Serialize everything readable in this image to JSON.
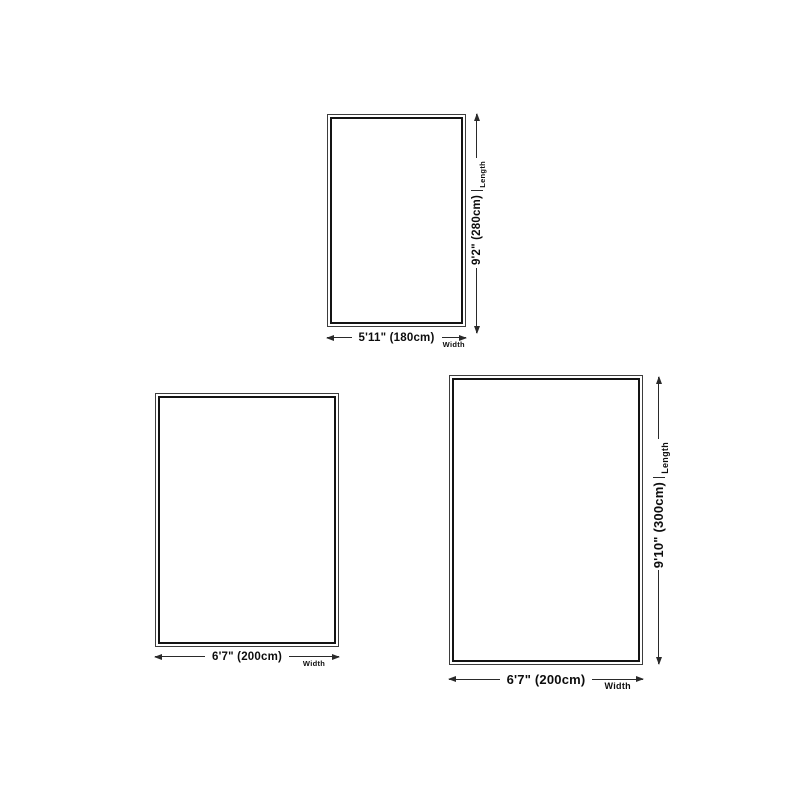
{
  "diagram": {
    "background": "#ffffff",
    "line_color": "#2a2a2a",
    "text_color": "#0d0d0d",
    "rug_outer_border": "#3d3d3d",
    "rug_inner_border": "#141414"
  },
  "rugs": [
    {
      "name": "rug-180x280",
      "width_value": "5'11\" (180cm)",
      "width_caption": "Width",
      "length_value": "9'2\" (280cm)",
      "length_caption": "Length"
    },
    {
      "name": "rug-200cm",
      "width_value": "6'7\" (200cm)",
      "width_caption": "Width"
    },
    {
      "name": "rug-200x300",
      "width_value": "6'7\" (200cm)",
      "width_caption": "Width",
      "length_value": "9'10\" (300cm)",
      "length_caption": "Length"
    }
  ]
}
